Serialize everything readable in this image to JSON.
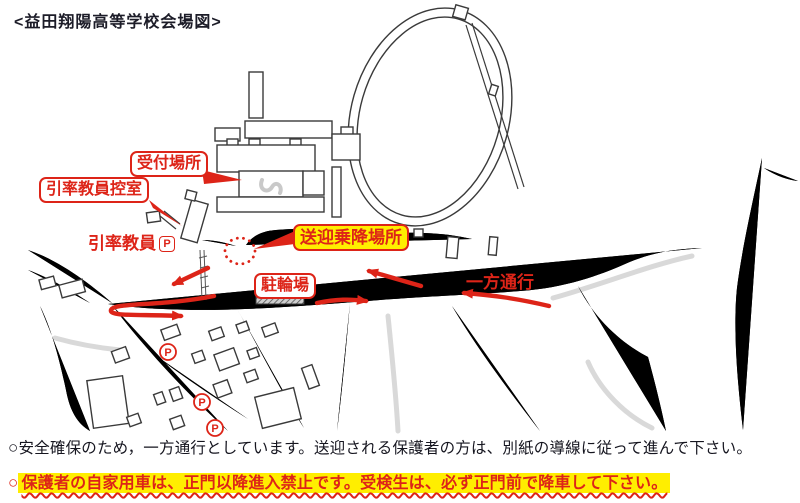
{
  "title": "<益田翔陽高等学校会場図>",
  "colors": {
    "red": "#dd2418",
    "yellow": "#ffee00",
    "road_ink": "#2e2e2e",
    "light_gray": "#d9d9d9"
  },
  "map": {
    "labels": {
      "reception": "受付場所",
      "teacher_room": "引率教員控室",
      "teacher_parking": "引率教員",
      "teacher_parking_mark": "P",
      "dropoff": "送迎乗降場所",
      "bicycle": "駐輪場",
      "one_way": "一方通行",
      "parking_mark": "P"
    }
  },
  "notes": [
    {
      "bullet": "○",
      "text": "安全確保のため，一方通行としています。送迎される保護者の方は、別紙の導線に従って進んで下さい。"
    },
    {
      "bullet": "○",
      "text": "保護者の自家用車は、正門以降進入禁止です。受検生は、必ず正門前で降車して下さい。"
    }
  ]
}
